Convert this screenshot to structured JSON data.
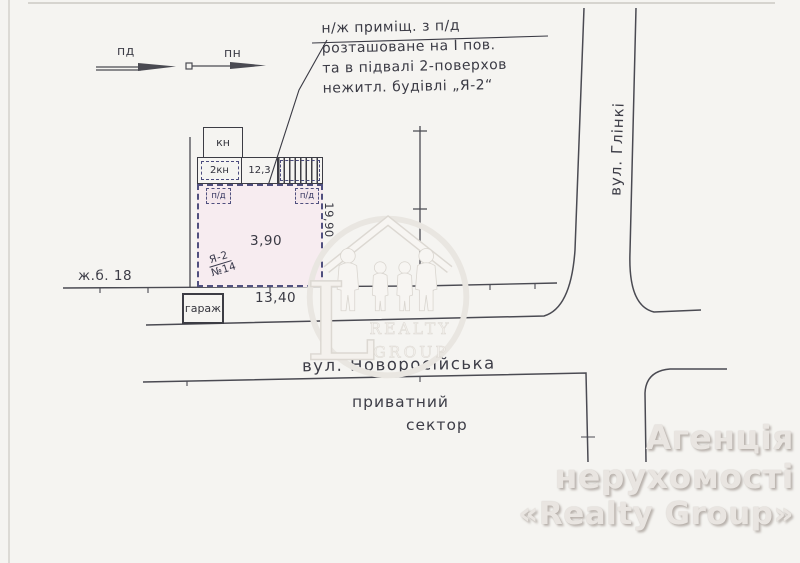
{
  "compass": {
    "pd": "пд",
    "pn": "пн"
  },
  "annotation": {
    "lines": [
      "н/ж приміщ. з п/д",
      "розташоване на І пов.",
      "та в підвалі 2-поверхов",
      "нежитл. будівлі „Я-2“"
    ]
  },
  "plan": {
    "kn_label": "кн",
    "strip_left_label": "2кн",
    "strip_area_label": "12,3",
    "pd_label": "п/д",
    "dim_inner": "3,90",
    "dim_height": "19,90",
    "dim_width": "13,40",
    "unit_line1": "Я-2",
    "unit_line2": "№14",
    "garage_label": "гараж",
    "neighbor_label": "ж.б. 18"
  },
  "streets": {
    "horizontal": "вул. Новоросійська",
    "vertical": "вул. Глінкі",
    "sector_line1": "приватний",
    "sector_line2": "сектор"
  },
  "logo": {
    "letter": "L",
    "word1": "REALTY",
    "word2": "GROUP"
  },
  "agency": {
    "line1": "Агенція",
    "line2": "нерухомості",
    "line3": "«Realty Group»"
  },
  "colors": {
    "paper": "#f5f4f1",
    "ink": "#4a4a52",
    "dashed_blue": "#50507f",
    "pink_fill": "#f7ecf0",
    "watermark_text": "#e9e5e1"
  }
}
